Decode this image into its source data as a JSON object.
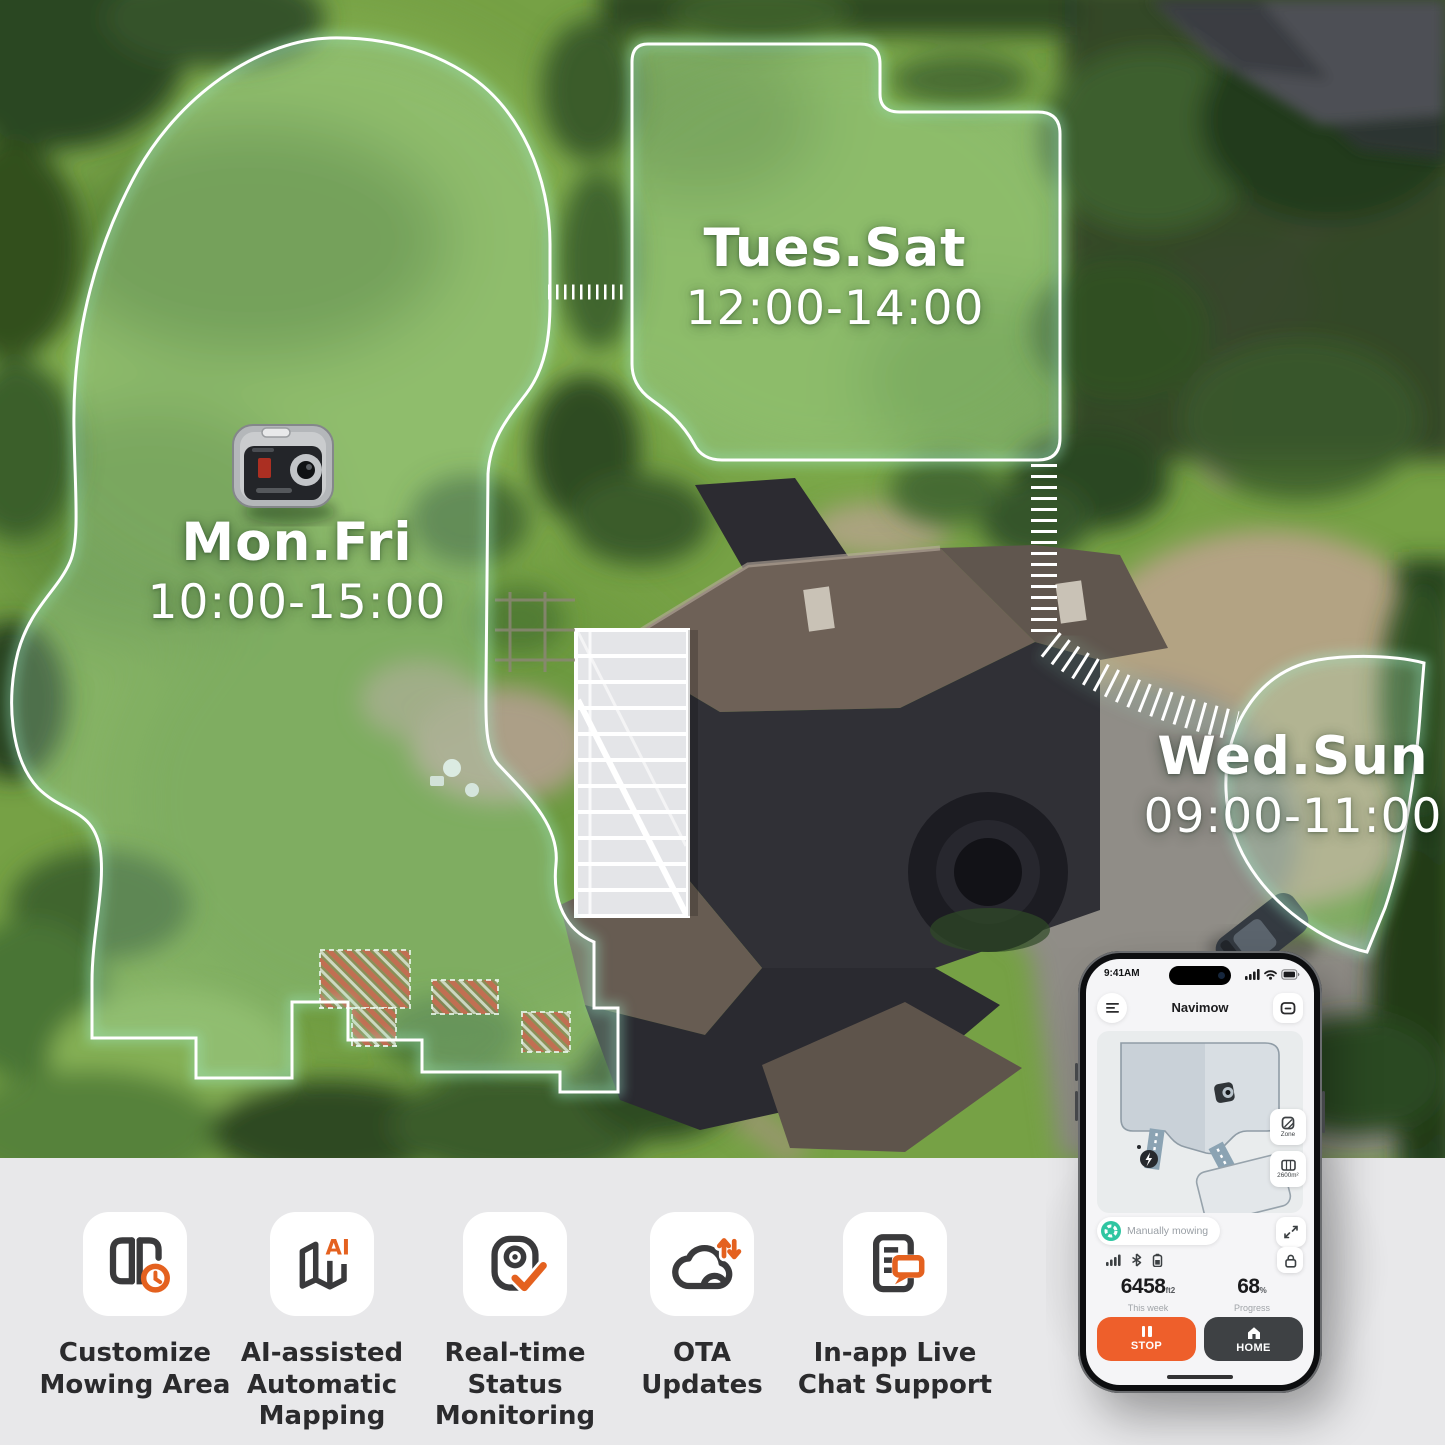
{
  "zones": {
    "mon_fri": {
      "days": "Mon.Fri",
      "time": "10:00-15:00"
    },
    "tues_sat": {
      "days": "Tues.Sat",
      "time": "12:00-14:00"
    },
    "wed_sun": {
      "days": "Wed.Sun",
      "time": "09:00-11:00"
    }
  },
  "features": [
    {
      "label": "Customize\nMowing Area",
      "icon": "mowing-area-clock-icon"
    },
    {
      "label": "AI-assisted\nAutomatic\nMapping",
      "icon": "map-ai-icon",
      "badge": "AI"
    },
    {
      "label": "Real-time\nStatus\nMonitoring",
      "icon": "monitor-check-icon"
    },
    {
      "label": "OTA\nUpdates",
      "icon": "cloud-sync-icon"
    },
    {
      "label": "In-app Live\nChat Support",
      "icon": "doc-chat-icon"
    }
  ],
  "phone": {
    "status_bar": {
      "time": "9:41AM"
    },
    "header": {
      "title": "Navimow"
    },
    "map": {
      "zone_button": "Zone",
      "area_button": "2600m²"
    },
    "status_pill": "Manually mowing",
    "stats": {
      "area_value": "6458",
      "area_unit": "ft2",
      "area_caption": "This week",
      "progress_value": "68",
      "progress_unit": "%",
      "progress_caption": "Progress"
    },
    "actions": {
      "stop": "STOP",
      "home": "HOME"
    }
  },
  "colors": {
    "accent_orange": "#e4611f",
    "stop_button": "#ee5f2b",
    "home_button": "#3e4144",
    "status_teal": "#2fc6a2",
    "zone_outline": "#ffffff",
    "band_background": "#e8e8ea"
  }
}
